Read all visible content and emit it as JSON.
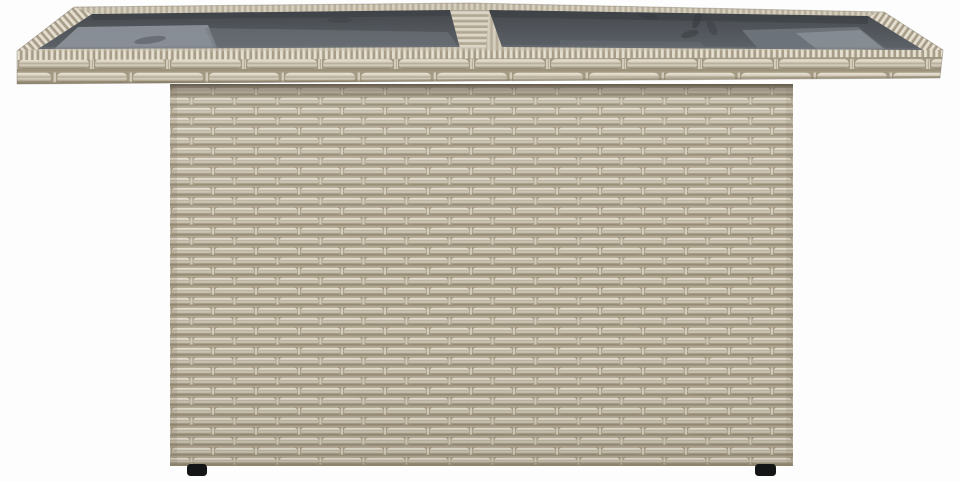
{
  "scene": {
    "type": "product-photo",
    "subject": "Light grey poly rattan garden table with two dark glass tabletop panels, wide woven pedestal base and two small black feet, on a plain white background"
  },
  "colors": {
    "background": "#fdfdfd",
    "rattan_pill_hi": "#ebe5d7",
    "rattan_pill": "#d7d0bf",
    "rattan_pill_shadow": "#b3aa96",
    "rattan_gap": "#a49a84",
    "rattan_deep": "#867c66",
    "rim_light": "#dcd5c5",
    "rim_dark": "#a69c87",
    "rim_base": "#c8c0ae",
    "under_shadow": "#5f5547",
    "glass_top": "#45494e",
    "glass_bottom": "#5d6268",
    "glass_reflect_hi": "#8e949b",
    "glass_reflect_mid": "#71777e",
    "glass_smudge": "#33373b",
    "foot_black": "#141517"
  }
}
